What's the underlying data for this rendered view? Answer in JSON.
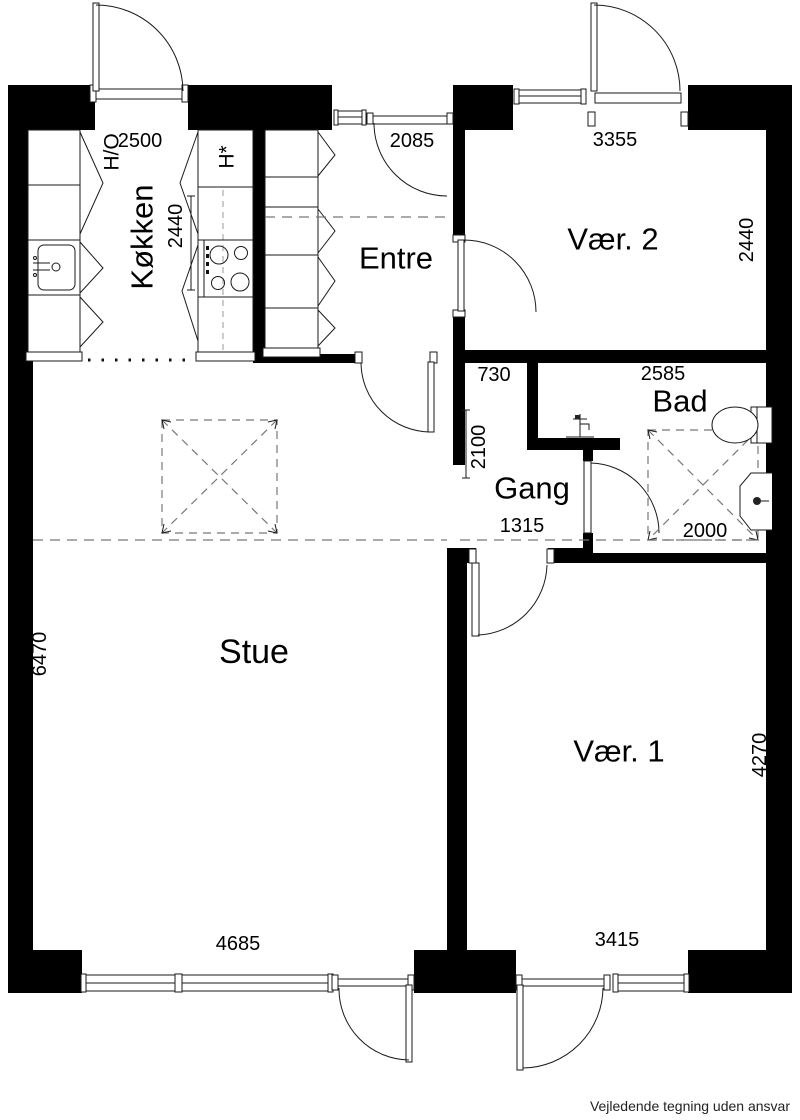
{
  "rooms": {
    "kokken": {
      "label": "Køkken"
    },
    "entre": {
      "label": "Entre"
    },
    "vaer2": {
      "label": "Vær. 2"
    },
    "bad": {
      "label": "Bad"
    },
    "gang": {
      "label": "Gang"
    },
    "stue": {
      "label": "Stue"
    },
    "vaer1": {
      "label": "Vær. 1"
    }
  },
  "fixtures": {
    "fridge_oven_label": "H/O",
    "appliance_label": "H*"
  },
  "dimensions_mm": {
    "kokken_width": "2500",
    "kokken_depth": "2440",
    "entre_width": "2085",
    "vaer2_width": "3355",
    "vaer2_depth": "2440",
    "niche_width": "730",
    "bad_width": "2585",
    "gang_length": "2100",
    "gang_width": "1315",
    "bad_inner_width": "2000",
    "stue_depth": "6470",
    "stue_width": "4685",
    "vaer1_width": "3415",
    "vaer1_depth": "4270"
  },
  "footer": {
    "disclaimer": "Vejledende tegning uden ansvar"
  },
  "colors": {
    "wall": "#000000",
    "line": "#1a1a1a",
    "dashed": "#777777",
    "background": "#ffffff"
  }
}
